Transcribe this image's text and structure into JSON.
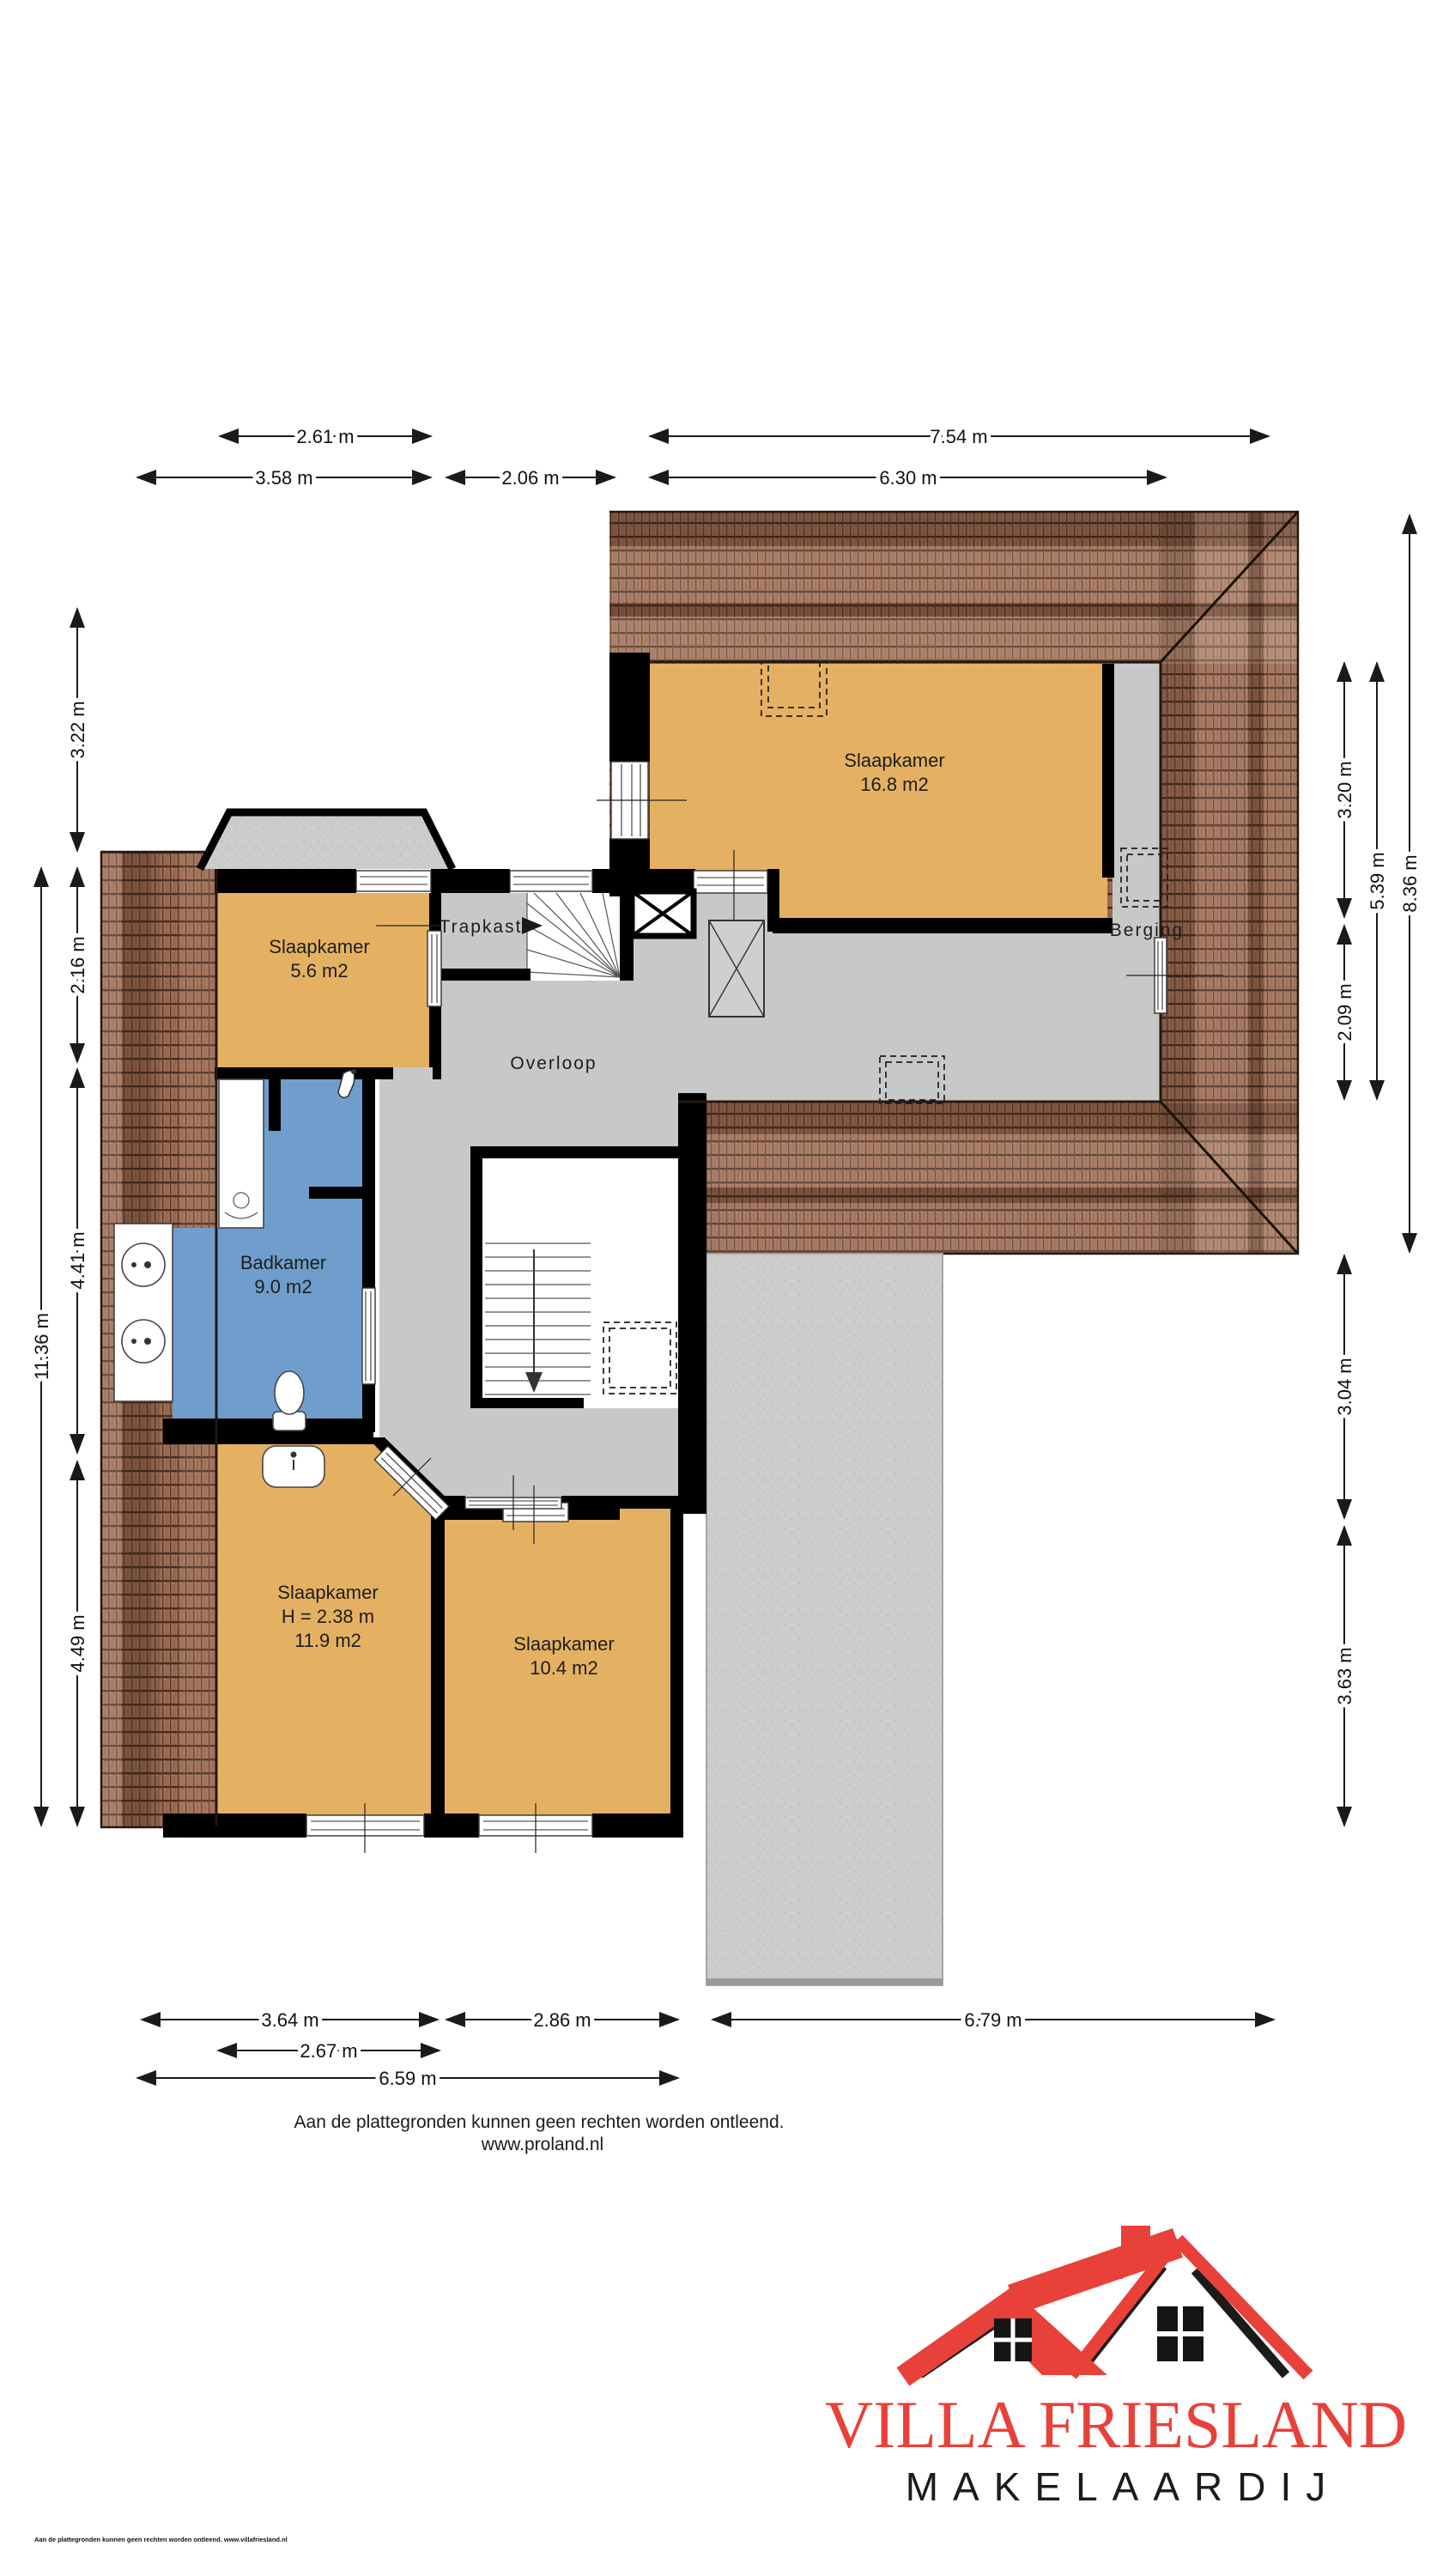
{
  "plan": {
    "rooms": {
      "slaapkamer_16_8": {
        "name": "Slaapkamer",
        "area": "16.8 m2"
      },
      "slaapkamer_5_6": {
        "name": "Slaapkamer",
        "area": "5.6 m2"
      },
      "badkamer": {
        "name": "Badkamer",
        "area": "9.0 m2"
      },
      "slaapkamer_11_9": {
        "name": "Slaapkamer",
        "height": "H = 2.38 m",
        "area": "11.9 m2"
      },
      "slaapkamer_10_4": {
        "name": "Slaapkamer",
        "area": "10.4 m2"
      }
    },
    "areas": {
      "trapkast": "Trapkast",
      "overloop": "Overloop",
      "berging": "Berging"
    },
    "dimensions": {
      "top": [
        "2.61 m",
        "7.54 m",
        "3.58 m",
        "2.06 m",
        "6.30 m"
      ],
      "left": [
        "3.22 m",
        "2.16 m",
        "4.41 m",
        "4.49 m",
        "11.36 m"
      ],
      "right": [
        "3.20 m",
        "2.09 m",
        "5.39 m",
        "8.36 m",
        "3.04 m",
        "3.63 m"
      ],
      "bottom": [
        "3.64 m",
        "2.86 m",
        "6.79 m",
        "2.67 m",
        "6.59 m"
      ]
    },
    "colors": {
      "room_orange": "#e4b163",
      "bathroom_blue": "#6f9ecd",
      "floor_gray": "#c8c8c8",
      "roof_brown": "#9b6b53",
      "concrete_gray": "#ccccca",
      "wall_black": "#000000"
    }
  },
  "footer": {
    "disclaimer": "Aan de plattegronden kunnen geen rechten worden ontleend.",
    "website": "www.proland.nl"
  },
  "fine_print": "Aan de plattegronden kunnen geen rechten worden ontleend. www.villafriesland.nl",
  "logo": {
    "title": "VILLA FRIESLAND",
    "subtitle": "MAKELAARDIJ",
    "red": "#e8413a",
    "black": "#1b1b1b"
  }
}
